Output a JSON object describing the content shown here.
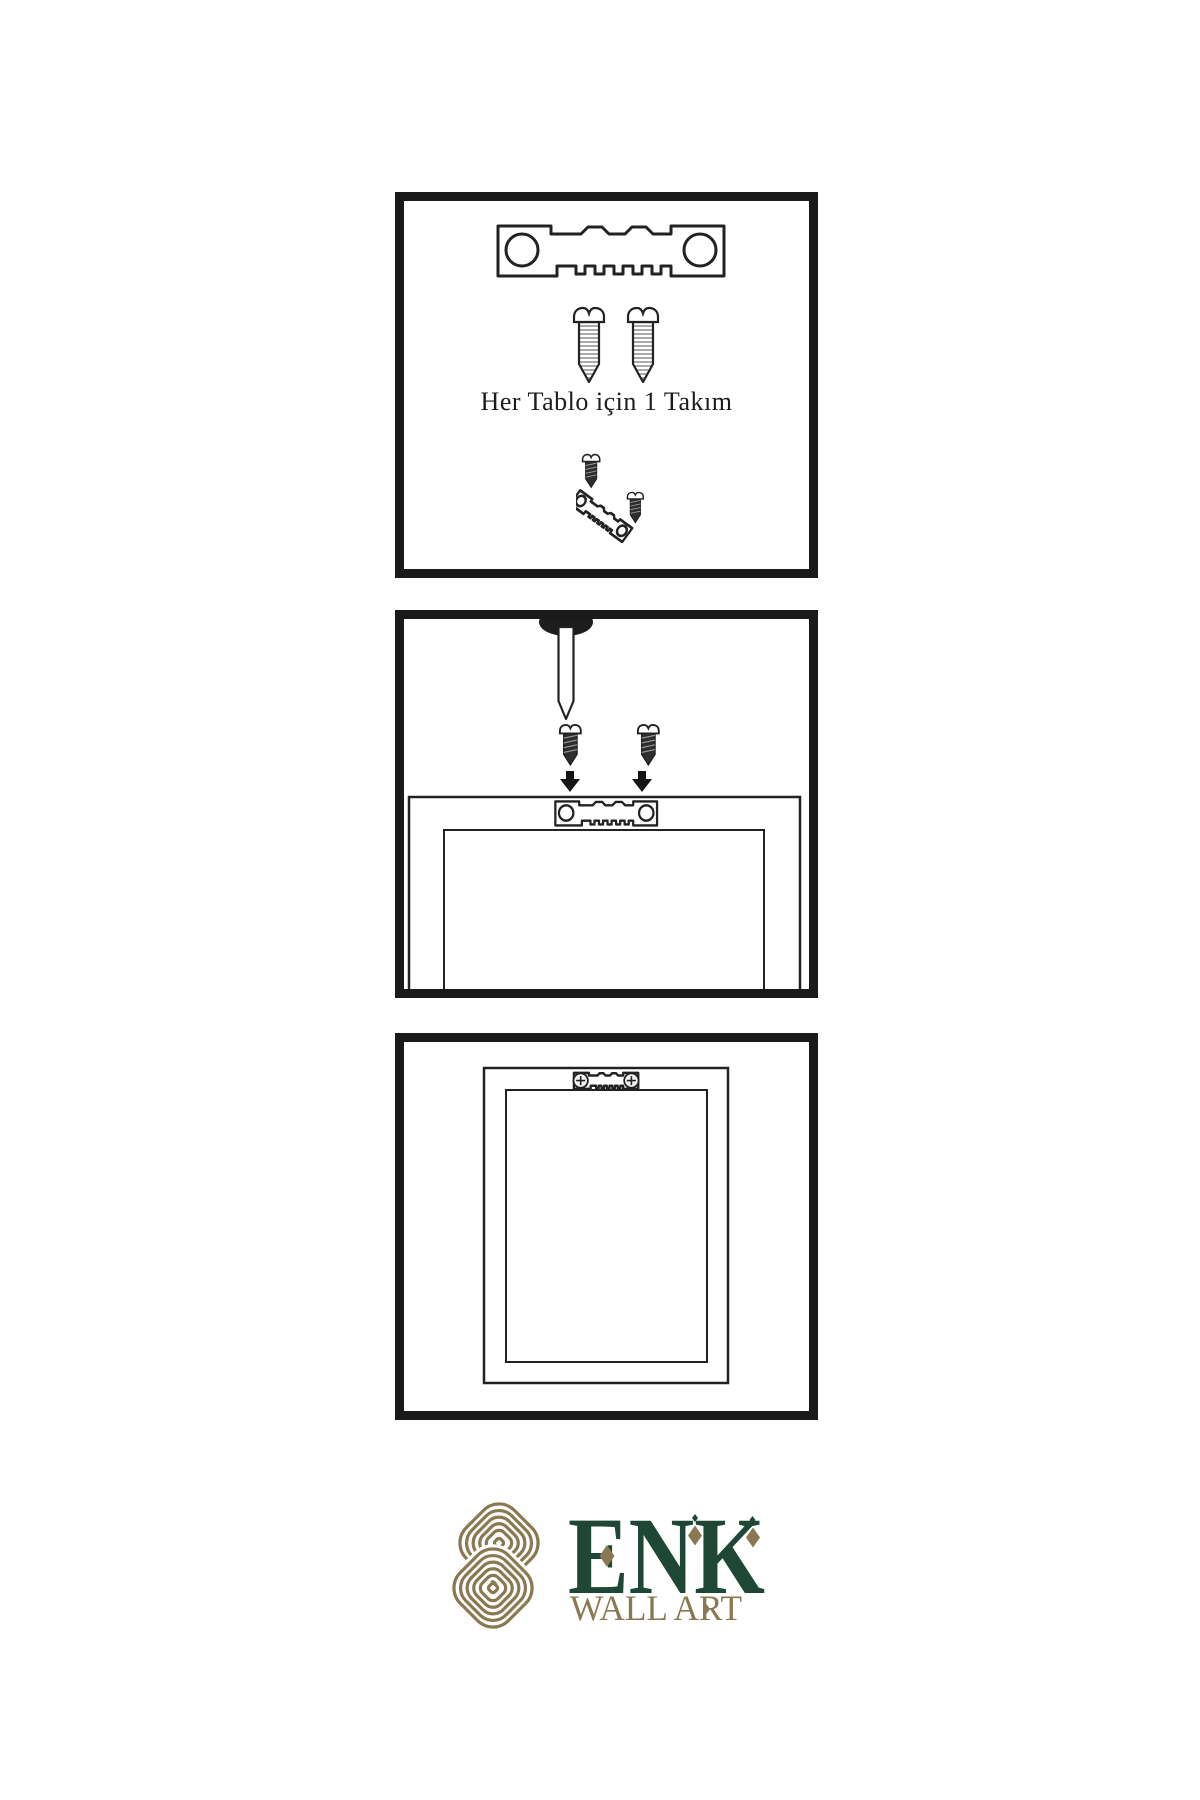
{
  "colors": {
    "background": "#ffffff",
    "ink": "#222222",
    "panel_border": "#1a1a1a",
    "screw_dark": "#2e2e2e",
    "logo_green": "#1e4735",
    "logo_gold": "#8a7850"
  },
  "steps": [
    {
      "id": "step-1-hardware-kit",
      "caption": "Her Tablo için 1 Takım",
      "icons": [
        "sawtooth-hanger-icon",
        "screw-icon",
        "screw-icon",
        "screw-driving-into-hanger-icon"
      ]
    },
    {
      "id": "step-2-attach-hanger-and-nail",
      "icons": [
        "nail-icon",
        "dark-screw-icon",
        "dark-screw-icon",
        "down-arrow-icon",
        "down-arrow-icon",
        "sawtooth-hanger-icon",
        "frame-back-icon"
      ]
    },
    {
      "id": "step-3-hang-frame",
      "icons": [
        "frame-front-icon",
        "mounted-sawtooth-hanger-icon"
      ]
    }
  ],
  "logo": {
    "brand": "ENK",
    "tagline": "WALL ART",
    "icon": "interlocking-knot-icon"
  }
}
